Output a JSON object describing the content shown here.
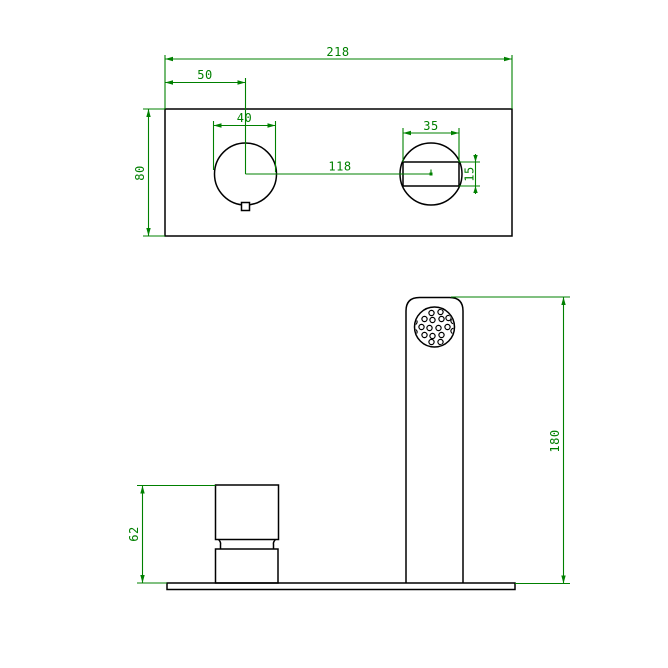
{
  "drawing_title": "wall-mounted basin mixer technical drawing",
  "colors": {
    "background": "#ffffff",
    "object_line": "#000000",
    "dimension_line": "#008000"
  },
  "top_view": {
    "name": "plan view of mounting plate",
    "dims": {
      "overall_width": "218",
      "left_hole_offset": "50",
      "left_hole_diameter": "40",
      "right_hole_width": "35",
      "hole_center_distance": "118",
      "overall_depth": "80",
      "slot_height": "15"
    }
  },
  "front_view": {
    "name": "front elevation of spout and handle",
    "dims": {
      "spout_height": "180",
      "handle_height": "62"
    }
  }
}
